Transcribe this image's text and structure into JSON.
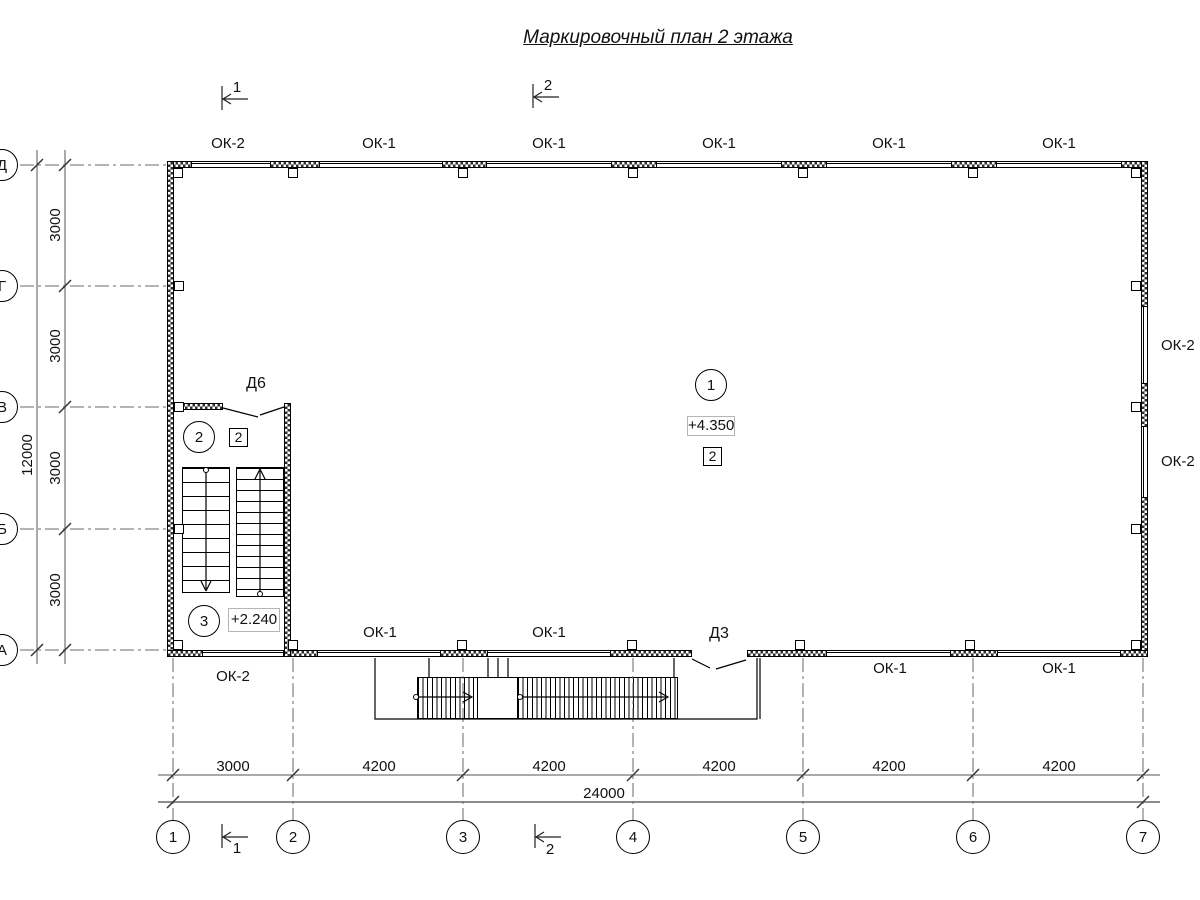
{
  "title": "Маркировочный план 2 этажа",
  "sections": {
    "top": [
      "1",
      "2"
    ],
    "bottom": [
      "1",
      "2"
    ]
  },
  "windows": {
    "top": [
      "ОК-2",
      "ОК-1",
      "ОК-1",
      "ОК-1",
      "ОК-1",
      "ОК-1"
    ],
    "right": [
      "ОК-2",
      "ОК-2"
    ],
    "bottom_inside": [
      "ОК-1",
      "ОК-1"
    ],
    "bottom_outside": [
      "ОК-2",
      "ОК-1",
      "ОК-1"
    ]
  },
  "doors": {
    "d6": "Д6",
    "d3": "Д3"
  },
  "rooms": [
    {
      "number": "1",
      "elevation": "+4.350",
      "finish": "2"
    },
    {
      "number": "2",
      "finish": "2"
    },
    {
      "number": "3",
      "elevation": "+2.240"
    }
  ],
  "axes": {
    "columns": [
      "1",
      "2",
      "3",
      "4",
      "5",
      "6",
      "7"
    ],
    "rows": [
      "Д",
      "Г",
      "В",
      "Б",
      "А"
    ]
  },
  "dimensions": {
    "bottom_segments": [
      "3000",
      "4200",
      "4200",
      "4200",
      "4200",
      "4200"
    ],
    "bottom_total": "24000",
    "left_segments": [
      "3000",
      "3000",
      "3000",
      "3000"
    ],
    "left_total": "12000"
  }
}
